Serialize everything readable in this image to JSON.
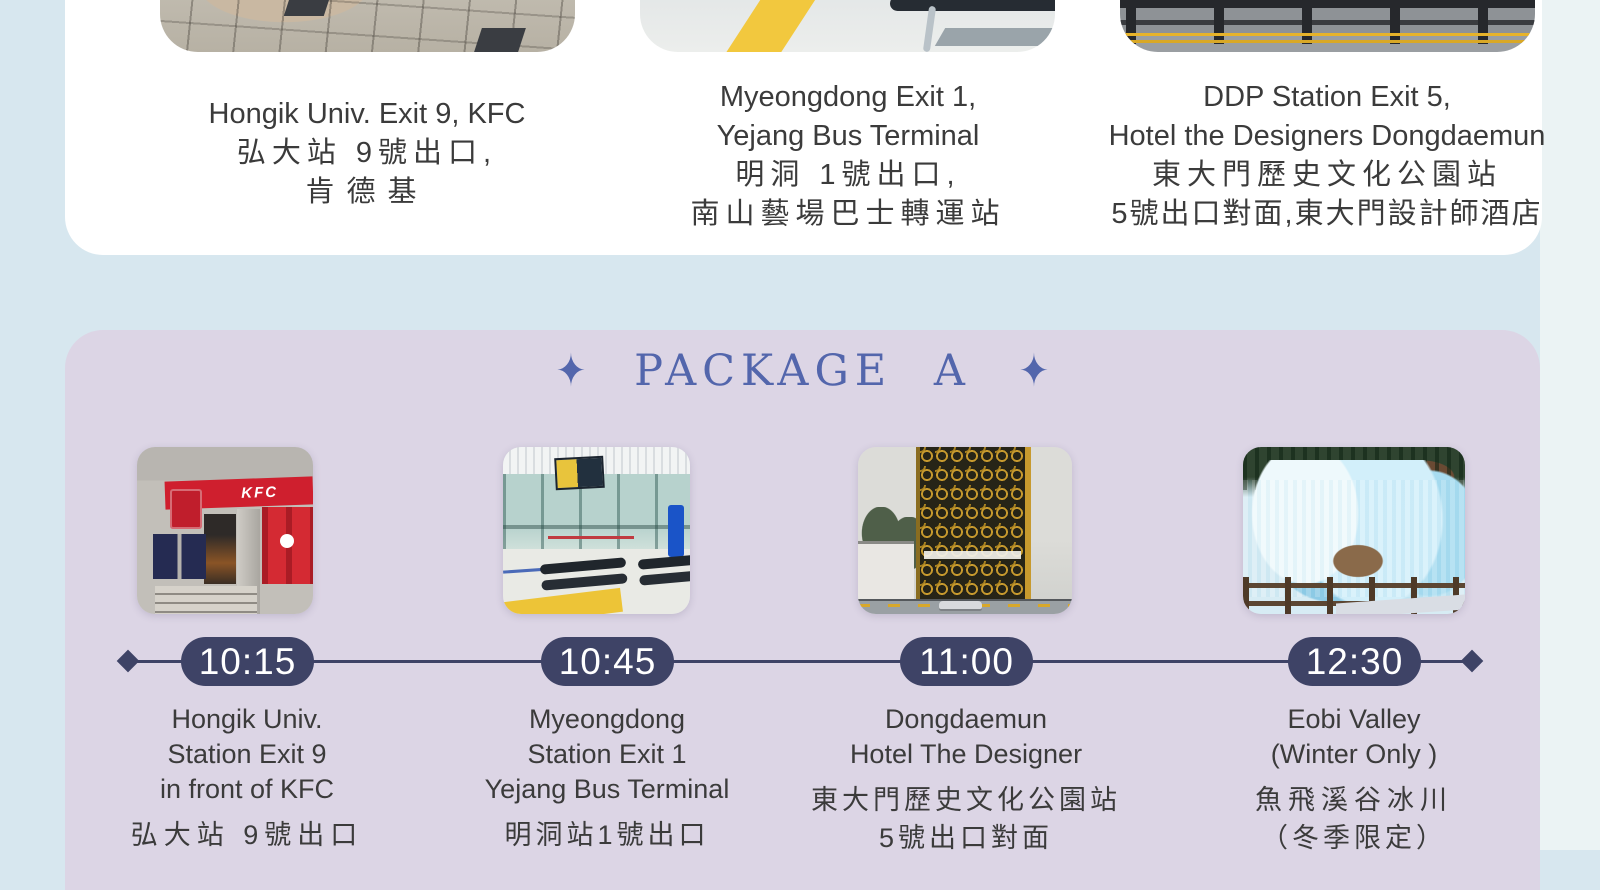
{
  "colors": {
    "page_bg": "#d7e7ef",
    "right_strip_bg": "#ebf3f4",
    "card_bg": "#ffffff",
    "panel_bg": "#dcd5e5",
    "accent_blue": "#5366ac",
    "badge_navy": "#3e4366",
    "text_dark": "#3b3b3b",
    "kfc_red": "#cf1f2e",
    "ice_blue": "#a8dcf0"
  },
  "pickup": {
    "stops": [
      {
        "photo": "hongik-pavement-photo",
        "photo_desc": "plaza pavement tiles outside Hongik Univ. exit",
        "lines": [
          "Hongik Univ. Exit 9, KFC",
          "弘大站 9號出口,",
          "肯德基"
        ]
      },
      {
        "photo": "myeongdong-station-photo",
        "photo_desc": "station floor with yellow line and metal benches",
        "lines": [
          "Myeongdong Exit 1,",
          "Yejang Bus Terminal",
          "明洞 1號出口,",
          "南山藝場巴士轉運站"
        ]
      },
      {
        "photo": "ddp-street-photo",
        "photo_desc": "street crossing with black and yellow bollard fence",
        "lines": [
          "DDP Station Exit 5,",
          "Hotel the Designers Dongdaemun",
          "東大門歷史文化公園站",
          "5號出口對面,東大門設計師酒店"
        ]
      }
    ]
  },
  "package_a": {
    "title": "PACKAGE A",
    "sparkle": "✦",
    "stops": [
      {
        "time": "10:15",
        "photo": "kfc-storefront-photo",
        "photo_desc": "KFC storefront with red sign band",
        "photo_sign": "KFC",
        "lines_en": [
          "Hongik Univ.",
          "Station Exit 9",
          "in front of KFC"
        ],
        "lines_zh": [
          "弘大站 9號出口"
        ]
      },
      {
        "time": "10:45",
        "photo": "yejang-terminal-photo",
        "photo_desc": "station interior with glass doors and benches",
        "lines_en": [
          "Myeongdong",
          "Station Exit 1",
          "Yejang Bus Terminal"
        ],
        "lines_zh": [
          "明洞站1號出口"
        ]
      },
      {
        "time": "11:00",
        "photo": "designer-hotel-photo",
        "photo_desc": "Hotel The Designer tower with gold honeycomb facade",
        "lines_en": [
          "Dongdaemun",
          "Hotel The Designer"
        ],
        "lines_zh": [
          "東大門歷史文化公園站",
          "5號出口對面"
        ]
      },
      {
        "time": "12:30",
        "photo": "eobi-valley-photo",
        "photo_desc": "frozen blue icefall with wooden fence",
        "lines_en": [
          "Eobi Valley",
          "(Winter Only )"
        ],
        "lines_zh": [
          "魚飛溪谷冰川",
          "（冬季限定）"
        ]
      }
    ]
  }
}
